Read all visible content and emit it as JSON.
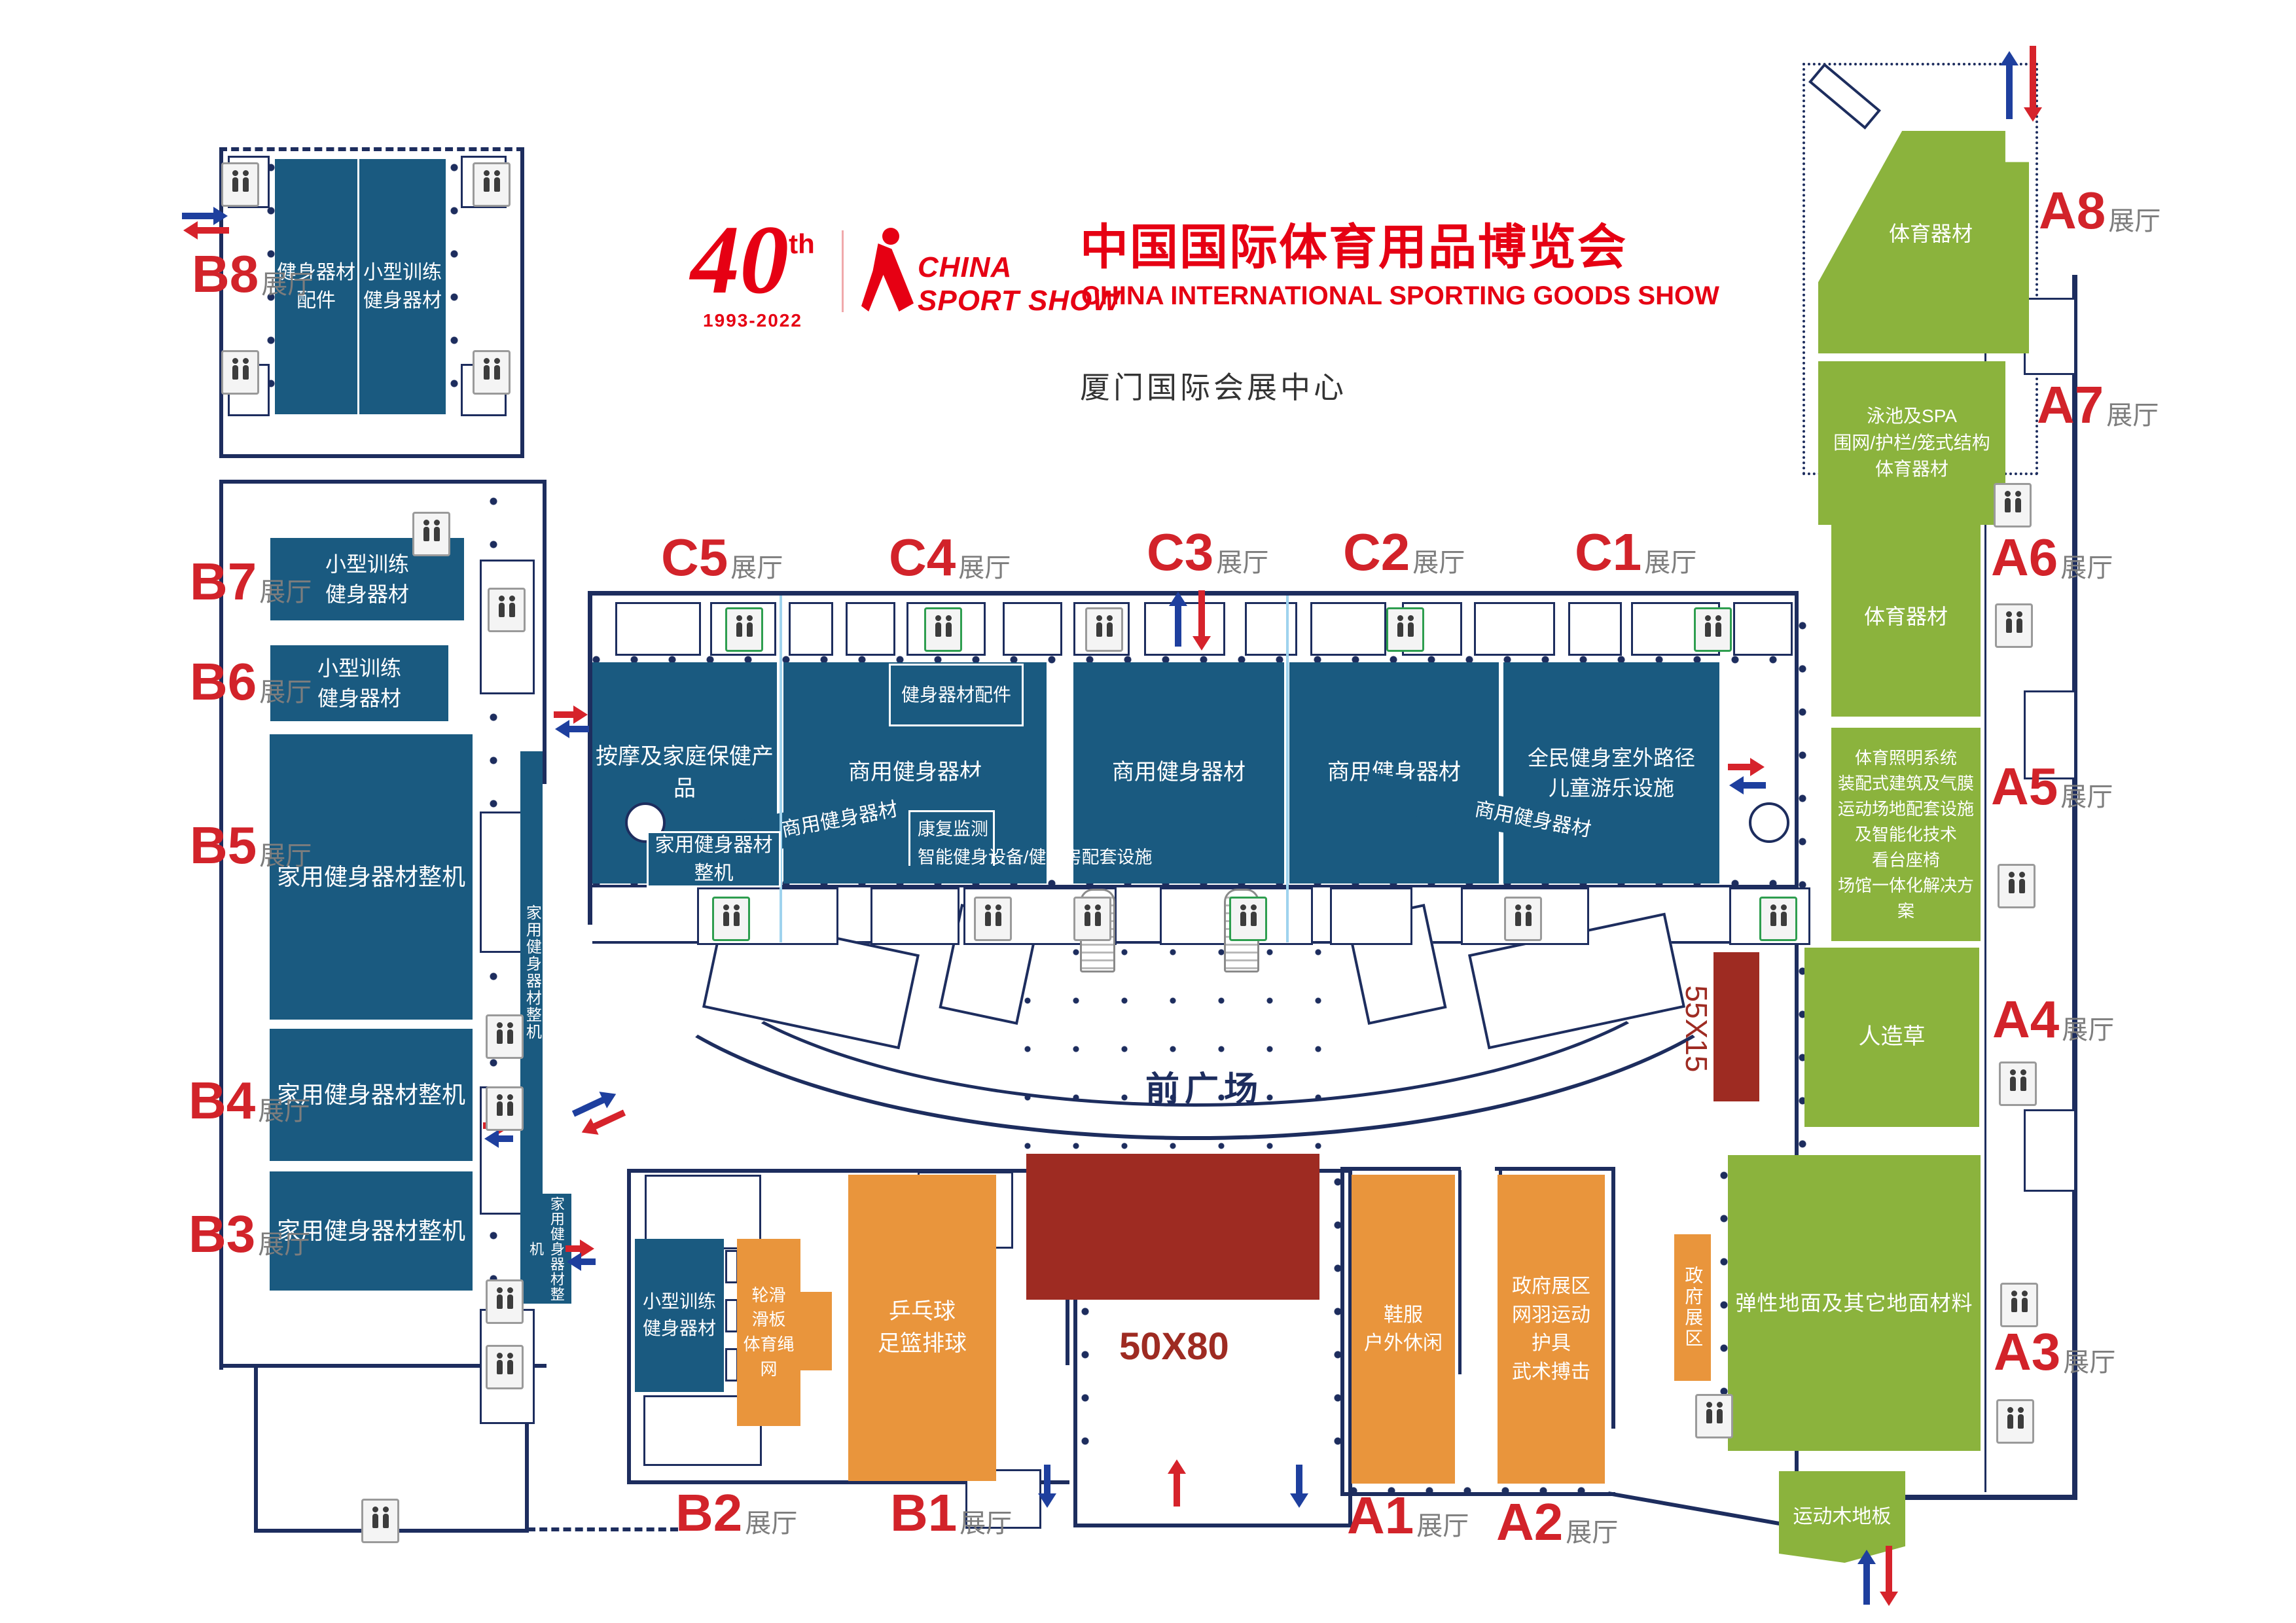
{
  "header": {
    "logo40": {
      "number": "40",
      "sup": "th",
      "years": "1993-2022"
    },
    "logoCss": {
      "line1": "CHINA",
      "line2": "SPORT SHOW"
    },
    "title_cn": "中国国际体育用品博览会",
    "title_en": "CHINA INTERNATIONAL SPORTING GOODS SHOW",
    "venue": "厦门国际会展中心"
  },
  "plaza": {
    "front_square": "前广场",
    "stage_size": "50X80",
    "strip_size": "55X15"
  },
  "hall_labels": {
    "B8": {
      "code": "B8",
      "suffix": "展厅"
    },
    "B7": {
      "code": "B7",
      "suffix": "展厅"
    },
    "B6": {
      "code": "B6",
      "suffix": "展厅"
    },
    "B5": {
      "code": "B5",
      "suffix": "展厅"
    },
    "B4": {
      "code": "B4",
      "suffix": "展厅"
    },
    "B3": {
      "code": "B3",
      "suffix": "展厅"
    },
    "B2": {
      "code": "B2",
      "suffix": "展厅"
    },
    "B1": {
      "code": "B1",
      "suffix": "展厅"
    },
    "C5": {
      "code": "C5",
      "suffix": "展厅"
    },
    "C4": {
      "code": "C4",
      "suffix": "展厅"
    },
    "C3": {
      "code": "C3",
      "suffix": "展厅"
    },
    "C2": {
      "code": "C2",
      "suffix": "展厅"
    },
    "C1": {
      "code": "C1",
      "suffix": "展厅"
    },
    "A8": {
      "code": "A8",
      "suffix": "展厅"
    },
    "A7": {
      "code": "A7",
      "suffix": "展厅"
    },
    "A6": {
      "code": "A6",
      "suffix": "展厅"
    },
    "A5": {
      "code": "A5",
      "suffix": "展厅"
    },
    "A4": {
      "code": "A4",
      "suffix": "展厅"
    },
    "A3": {
      "code": "A3",
      "suffix": "展厅"
    },
    "A2": {
      "code": "A2",
      "suffix": "展厅"
    },
    "A1": {
      "code": "A1",
      "suffix": "展厅"
    }
  },
  "blocks": {
    "b8_left": "健身器材\n配件",
    "b8_right": "小型训练\n健身器材",
    "b7": "小型训练\n健身器材",
    "b6": "小型训练\n健身器材",
    "b5": "家用健身器材整机",
    "b4": "家用健身器材整机",
    "b3": "家用健身器材整机",
    "strip_home_1": "家用健身器材整机",
    "strip_home_2": "家用健身器材整机",
    "c5": "按摩及家庭保健产品",
    "c5_sub": "家用健身器材整机",
    "c4": "商用健身器材",
    "c4_top": "健身器材配件",
    "c4_bot": "康复监测\n智能健身设备/健身房配套设施",
    "c3": "商用健身器材",
    "c2": "商用健身器材",
    "c1": "全民健身室外路径\n儿童游乐设施",
    "ramp_left": "商用健身器材",
    "ramp_right": "商用健身器材",
    "b2_blue": "小型训练\n健身器材",
    "b2_orange": "轮滑\n滑板\n体育绳网",
    "b1_orange": "乒乓球\n足篮排球",
    "a1": "鞋服\n户外休闲",
    "a2": "政府展区\n网羽运动\n护具\n武术搏击",
    "gov_strip": "政府展区",
    "a8": "体育器材",
    "a7": "泳池及SPA\n围网/护栏/笼式结构\n体育器材",
    "a6": "体育器材",
    "a5": "体育照明系统\n装配式建筑及气膜\n运动场地配套设施\n及智能化技术\n看台座椅\n场馆一体化解决方案",
    "a4": "人造草",
    "a3": "弹性地面及其它地面材料",
    "wood": "运动木地板"
  },
  "colors": {
    "hall_blue": "#1a5a80",
    "hall_green": "#8bb33d",
    "hall_orange": "#e9953c",
    "stage_darkred": "#9e2b22",
    "label_red": "#d2232a",
    "label_gray": "#7d7d7d",
    "wall_navy": "#1d2d5e",
    "title_red": "#e60013"
  }
}
